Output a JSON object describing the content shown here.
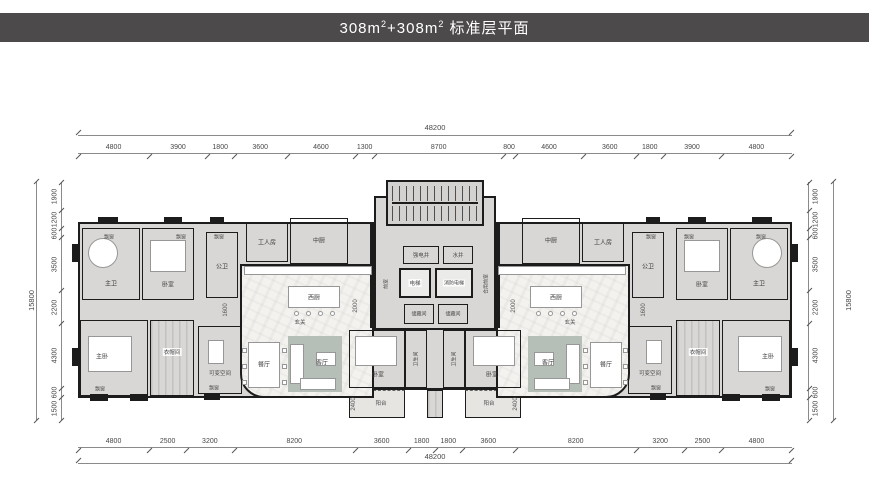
{
  "header": {
    "title_part1": "308m",
    "title_sup1": "2",
    "title_part2": "+308m",
    "title_sup2": "2",
    "title_part3": " 标准层平面"
  },
  "dims": {
    "top_total": "48200",
    "bottom_total": "48200",
    "left_total": "15800",
    "right_total": "15800",
    "top_segments": [
      "4800",
      "3900",
      "1800",
      "3600",
      "4600",
      "1300",
      "8700",
      "800",
      "4600",
      "3600",
      "1800",
      "3900",
      "4800"
    ],
    "bottom_segments": [
      "4800",
      "2500",
      "3200",
      "8200",
      "3600",
      "1800",
      "1800",
      "3600",
      "8200",
      "3200",
      "2500",
      "4800"
    ],
    "left_segments": [
      "1900",
      "1200",
      "600",
      "3500",
      "2200",
      "4300",
      "600",
      "1500"
    ],
    "right_segments": [
      "1900",
      "1200",
      "600",
      "3500",
      "2200",
      "4300",
      "600",
      "1500"
    ],
    "interior": {
      "kitchen_bay": "1600",
      "hall_width": "2000",
      "balcony_depth": "2400"
    }
  },
  "rooms": {
    "master_bath": "主卫",
    "bedroom": "卧室",
    "guest_bath": "公卫",
    "maid_room": "工人房",
    "chinese_kitchen": "中厨",
    "western_kitchen": "西厨",
    "foyer": "玄关",
    "dining": "餐厅",
    "living": "客厅",
    "master_bedroom": "主卧",
    "cloakroom": "衣帽间",
    "flex_space": "可变空间",
    "bathroom": "卫生间",
    "balcony": "阳台",
    "bay_window": "飘窗"
  },
  "core": {
    "elevator": "电梯",
    "fire_elevator": "消防电梯",
    "elec_shaft": "强电井",
    "water_shaft": "水井",
    "storage": "储藏间",
    "front_room": "前室",
    "shared_lobby": "合用前室"
  },
  "colors": {
    "header_bg": "#4c4a4a",
    "wall": "#1c1c1c",
    "floor_gray": "#d8d7d5",
    "floor_marble": "#f3f2ef",
    "furniture_accent": "#b5bfb7",
    "dim_line": "#8a8a8a"
  }
}
